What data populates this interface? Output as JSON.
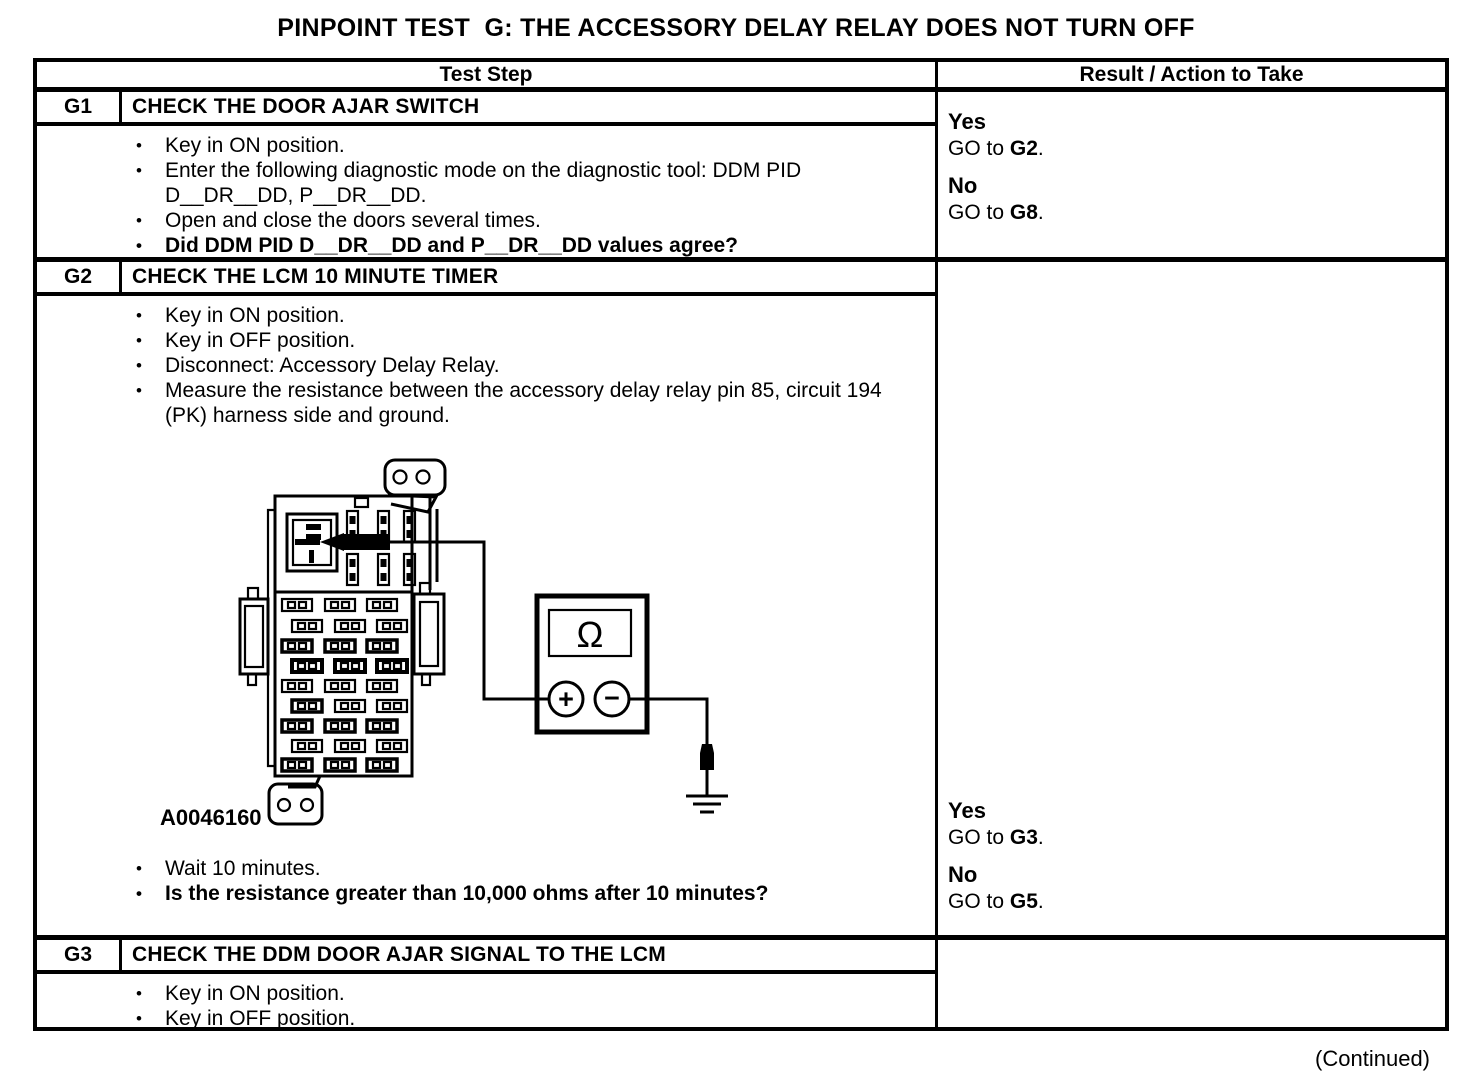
{
  "page": {
    "title": "PINPOINT TEST  G: THE ACCESSORY DELAY RELAY DOES NOT TURN OFF",
    "continued": "(Continued)"
  },
  "table": {
    "header": {
      "test_step": "Test Step",
      "result": "Result / Action to Take"
    },
    "steps": [
      {
        "id": "G1",
        "title": "CHECK THE DOOR AJAR SWITCH",
        "bullets": [
          {
            "text": "Key in ON position."
          },
          {
            "text": "Enter the following diagnostic mode on the diagnostic tool: DDM PID D__DR__DD, P__DR__DD."
          },
          {
            "text": "Open and close the doors several times."
          },
          {
            "text": "Did DDM PID D__DR__DD and P__DR__DD values agree?"
          }
        ],
        "results": [
          {
            "answer": "Yes",
            "go": "GO to ",
            "target": "G2",
            "period": "."
          },
          {
            "answer": "No",
            "go": "GO to ",
            "target": "G8",
            "period": "."
          }
        ]
      },
      {
        "id": "G2",
        "title": "CHECK THE LCM 10 MINUTE TIMER",
        "bullets_before_figure": [
          {
            "text": "Key in ON position."
          },
          {
            "text": "Key in OFF position."
          },
          {
            "text": "Disconnect: Accessory Delay Relay."
          },
          {
            "text": "Measure the resistance between the accessory delay relay pin 85, circuit 194 (PK) harness side and ground."
          }
        ],
        "figure": {
          "label": "A0046160",
          "meter_display": "Ω",
          "positive": "+",
          "negative": "−"
        },
        "bullets_after_figure": [
          {
            "text": "Wait 10 minutes."
          },
          {
            "text": "Is the resistance greater than 10,000 ohms after 10 minutes?"
          }
        ],
        "results": [
          {
            "answer": "Yes",
            "go": "GO to ",
            "target": "G3",
            "period": "."
          },
          {
            "answer": "No",
            "go": "GO to ",
            "target": "G5",
            "period": "."
          }
        ]
      },
      {
        "id": "G3",
        "title": "CHECK THE DDM DOOR AJAR SIGNAL TO THE LCM",
        "bullets": [
          {
            "text": "Key in ON position."
          },
          {
            "text": "Key in OFF position."
          }
        ]
      }
    ]
  }
}
